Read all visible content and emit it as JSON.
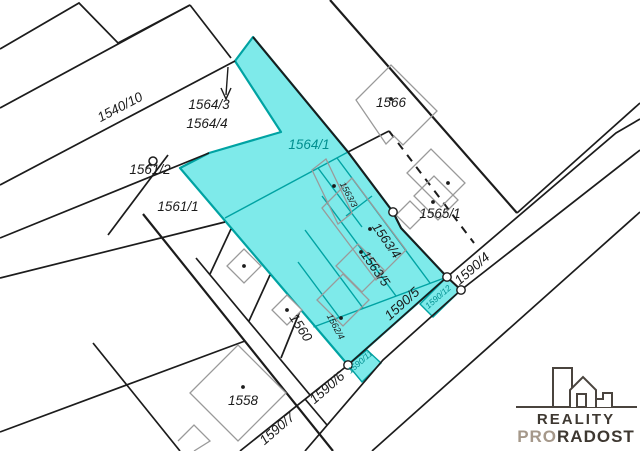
{
  "map": {
    "highlight_color": "#7EEAEA",
    "parcel_line_color": "#1C1C1C",
    "teal_line_color": "#00A3A3",
    "teal_text_color": "#008F8F",
    "building_outline_color": "#9A9A9A",
    "labels": [
      {
        "name": "1540-10",
        "text": "1540/10",
        "x": 122,
        "y": 111,
        "rot": -27.5,
        "size": 13.5,
        "color": "#1C1C1C"
      },
      {
        "name": "1564-3",
        "text": "1564/3",
        "x": 209,
        "y": 109,
        "rot": 0,
        "size": 13.5,
        "color": "#1C1C1C"
      },
      {
        "name": "1564-4",
        "text": "1564/4",
        "x": 207,
        "y": 128,
        "rot": 0,
        "size": 13.5,
        "color": "#1C1C1C"
      },
      {
        "name": "1561-2",
        "text": "1561/2",
        "x": 150,
        "y": 174,
        "rot": 0,
        "size": 13.5,
        "color": "#1C1C1C"
      },
      {
        "name": "1561-1",
        "text": "1561/1",
        "x": 178,
        "y": 211,
        "rot": 0,
        "size": 13.5,
        "color": "#1C1C1C"
      },
      {
        "name": "1564-1",
        "text": "1564/1",
        "x": 309,
        "y": 149,
        "rot": 0,
        "size": 13.5,
        "color": "#008F8F"
      },
      {
        "name": "1566",
        "text": "1566",
        "x": 391,
        "y": 107,
        "rot": 0,
        "size": 13.5,
        "color": "#1C1C1C"
      },
      {
        "name": "1565-1",
        "text": "1565/1",
        "x": 440,
        "y": 218,
        "rot": 0,
        "size": 13.5,
        "color": "#1C1C1C"
      },
      {
        "name": "1558",
        "text": "1558",
        "x": 243,
        "y": 405,
        "rot": 0,
        "size": 13.5,
        "color": "#1C1C1C"
      },
      {
        "name": "1563-3",
        "text": "1563/3",
        "x": 346,
        "y": 196,
        "rot": 62,
        "size": 9,
        "color": "#1C1C1C"
      },
      {
        "name": "1563-4",
        "text": "1563/4",
        "x": 383,
        "y": 243,
        "rot": 55,
        "size": 13,
        "color": "#1C1C1C"
      },
      {
        "name": "1563-5",
        "text": "1563/5",
        "x": 372,
        "y": 271,
        "rot": 55,
        "size": 13,
        "color": "#1C1C1C"
      },
      {
        "name": "1562-4",
        "text": "1562/4",
        "x": 333,
        "y": 328,
        "rot": 62,
        "size": 9,
        "color": "#1C1C1C"
      },
      {
        "name": "1560",
        "text": "1560",
        "x": 297,
        "y": 330,
        "rot": 57,
        "size": 13.5,
        "color": "#1C1C1C"
      },
      {
        "name": "1590-4",
        "text": "1590/4",
        "x": 475,
        "y": 272,
        "rot": -41,
        "size": 13.5,
        "color": "#1C1C1C"
      },
      {
        "name": "1590-5",
        "text": "1590/5",
        "x": 405,
        "y": 307,
        "rot": -42,
        "size": 13.5,
        "color": "#1C1C1C"
      },
      {
        "name": "1590-6",
        "text": "1590/6",
        "x": 330,
        "y": 391,
        "rot": -41,
        "size": 13.5,
        "color": "#1C1C1C"
      },
      {
        "name": "1590-7",
        "text": "1590/7",
        "x": 280,
        "y": 432,
        "rot": -41,
        "size": 13.5,
        "color": "#1C1C1C"
      },
      {
        "name": "1590-11",
        "text": "1590/11",
        "x": 362,
        "y": 364,
        "rot": -41,
        "size": 8.5,
        "color": "#008F8F"
      },
      {
        "name": "1590-12",
        "text": "1590/12",
        "x": 440,
        "y": 299,
        "rot": -41,
        "size": 8.5,
        "color": "#008F8F"
      }
    ],
    "building_dots": [
      [
        391,
        99
      ],
      [
        448,
        183
      ],
      [
        433,
        202
      ],
      [
        334,
        186
      ],
      [
        370,
        229
      ],
      [
        361,
        252
      ],
      [
        341,
        318
      ],
      [
        244,
        266
      ],
      [
        287,
        310
      ],
      [
        243,
        387
      ]
    ],
    "boundary_circles": [
      [
        393,
        212
      ],
      [
        447,
        277
      ],
      [
        461,
        290
      ],
      [
        348,
        365
      ]
    ],
    "well_symbol": {
      "x": 153,
      "y": 161
    }
  },
  "logo": {
    "brand_top": "REALITY",
    "brand_bottom_accent": "PRO",
    "brand_bottom_rest": "RADOST",
    "dark_color": "#3E3831",
    "accent_color": "#A5988A"
  }
}
